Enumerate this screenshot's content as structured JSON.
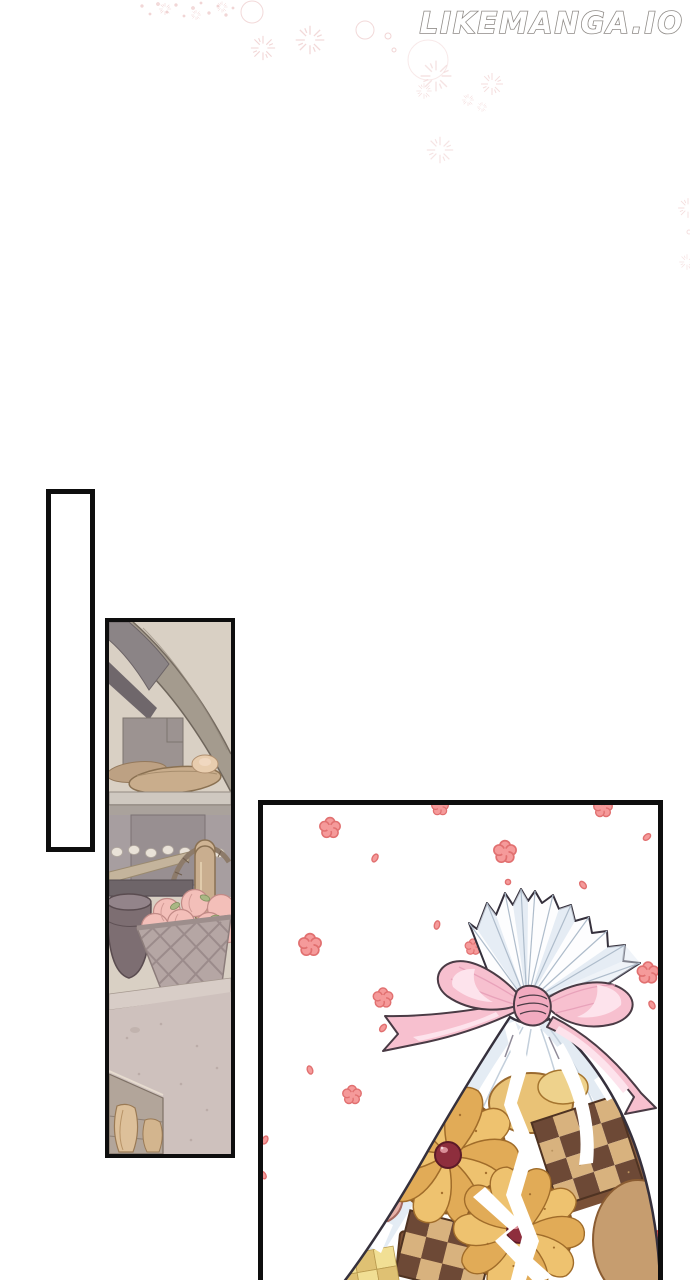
{
  "page": {
    "watermark": "LIKEMANGA.IO",
    "background": "#ffffff"
  },
  "panels": {
    "empty": {
      "label": "empty narration box"
    },
    "kitchen": {
      "label": "bakery kitchen: stone arched oven, shelf of bread loaves, wire basket of peaches on a stone counter"
    },
    "gift": {
      "label": "clear cellophane bag of assorted cookies tied with a pink ribbon bow, pink blossoms floating around"
    }
  },
  "colors": {
    "border_black": "#0e0e0e",
    "sparkle_pink": "#edc9c9",
    "blossom_fill": "#f59a9a",
    "blossom_stroke": "#e17070",
    "petal_dark": "#e05858",
    "ribbon_pink": "#f7c0cf",
    "ribbon_knot": "#f2abc0",
    "ribbon_highlight": "#fde3ec",
    "ribbon_outline": "#4a3b45",
    "bag_outline": "#35303c",
    "bag_shade": "#dde7f1",
    "cookie_gold": "#e9c276",
    "cookie_edge": "#8a5a26",
    "cherry": "#8e2e3d",
    "checker_dark": "#6d4936",
    "checker_light": "#d8b27e",
    "wall_beige": "#d9d0c4",
    "arch_stone": "#a49b8e",
    "counter_stone": "#cec1bd",
    "peach": "#f3bfb9",
    "bread_tan": "#c9ad8c"
  }
}
